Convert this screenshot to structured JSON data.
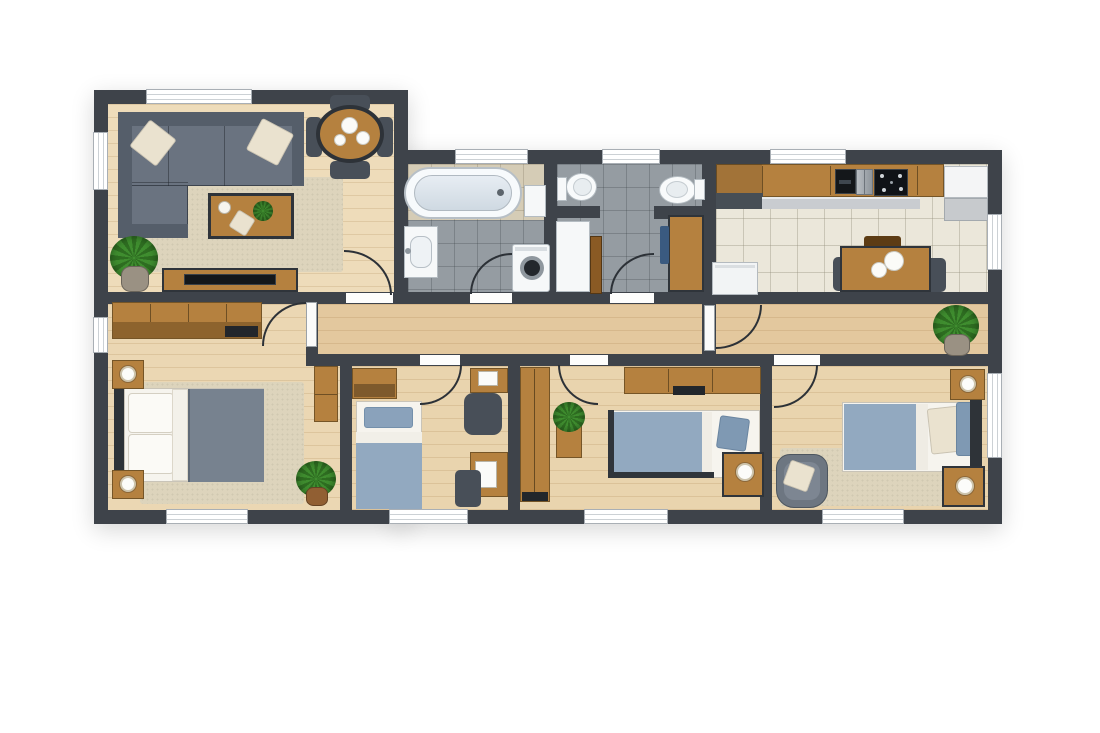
{
  "meta": {
    "type": "apartment-floor-plan",
    "view": "top-down architectural render",
    "background": "#ffffff",
    "counts": {
      "rooms": 9,
      "windows": 12,
      "interior_door_openings": 8
    }
  },
  "palette": {
    "wall": "#3e434a",
    "floor_living": "#eedcba",
    "floor_master": "#ebd7b3",
    "floor_bedroom": "#e9d4ae",
    "floor_hall": "#e3c89e",
    "tile_gray": "#959ca2",
    "tile_cream": "#ebe7da",
    "tile_beige": "#d5ccb6",
    "wood": "#b5813f",
    "wood_dark": "#8a5a24",
    "wood_edge": "#2f343a",
    "dark_accent": "#22262b",
    "sofa": "#6a7380",
    "sofa_dark": "#555e6a",
    "rug": "#ddd4bc",
    "pillow": "#eae2cf",
    "duvet_gray": "#77828f",
    "duvet_blue": "#92a9c0",
    "duvet_blue_dark": "#7f99b3",
    "sheet": "#f3f1ea",
    "mattress": "#f6f4ee",
    "plant": "#3f8d2f",
    "plant_dark": "#2e6d21",
    "pot": "#9a9183",
    "pot_brown": "#915f33",
    "fixture_white": "#f6f8f9",
    "fixture_border": "#b4bcc2",
    "appliance_gray": "#c7cacd",
    "arc_line": "#2c3137",
    "window_border": "#a9afb5",
    "window_line": "#ccd1d5",
    "chair_dark": "#484f58",
    "towel_blue": "#3a5a80",
    "black": "#14171a"
  },
  "rooms": [
    {
      "name": "living-room",
      "furniture": [
        "sectional-sofa",
        "throw-pillow",
        "throw-pillow",
        "area-rug",
        "coffee-table",
        "decor-bowl",
        "table-plant",
        "accent-pillow",
        "round-dining-table",
        "dining-chair",
        "dining-chair",
        "dining-chair",
        "dining-chair",
        "dinner-plates",
        "potted-plant",
        "tv-console",
        "television"
      ]
    },
    {
      "name": "bathroom",
      "furniture": [
        "bathtub",
        "wall-cabinet",
        "washbasin",
        "washing-machine"
      ]
    },
    {
      "name": "toilet-room",
      "furniture": [
        "toilet",
        "bidet",
        "storage-cabinet",
        "tall-cabinet",
        "vanity-table",
        "hand-towel"
      ]
    },
    {
      "name": "kitchen",
      "furniture": [
        "kitchen-counter",
        "wall-oven",
        "kitchen-sink",
        "cooktop",
        "refrigerator",
        "dishwasher",
        "dining-table",
        "dining-chair",
        "dining-chair",
        "dining-bench",
        "dinner-plates"
      ]
    },
    {
      "name": "hallway",
      "furniture": [
        "potted-plant",
        "connecting-door"
      ]
    },
    {
      "name": "master-bedroom",
      "furniture": [
        "dresser",
        "media-tray",
        "double-bed",
        "bed-pillows",
        "nightstand",
        "nightstand",
        "table-lamp",
        "table-lamp",
        "area-rug",
        "side-cabinet",
        "potted-plant"
      ]
    },
    {
      "name": "bedroom-2",
      "furniture": [
        "single-bed",
        "storage-cabinet",
        "desk",
        "desk",
        "desk-chair",
        "desk-chair",
        "laptop",
        "notebook"
      ]
    },
    {
      "name": "bedroom-3",
      "furniture": [
        "single-bed",
        "tall-wardrobe",
        "wardrobe-unit",
        "plant-stand",
        "potted-plant",
        "nightstand",
        "table-lamp"
      ]
    },
    {
      "name": "bedroom-4",
      "furniture": [
        "bed",
        "nightstand",
        "nightstand",
        "table-lamp",
        "table-lamp",
        "armchair",
        "throw-pillow",
        "area-rug"
      ]
    }
  ]
}
